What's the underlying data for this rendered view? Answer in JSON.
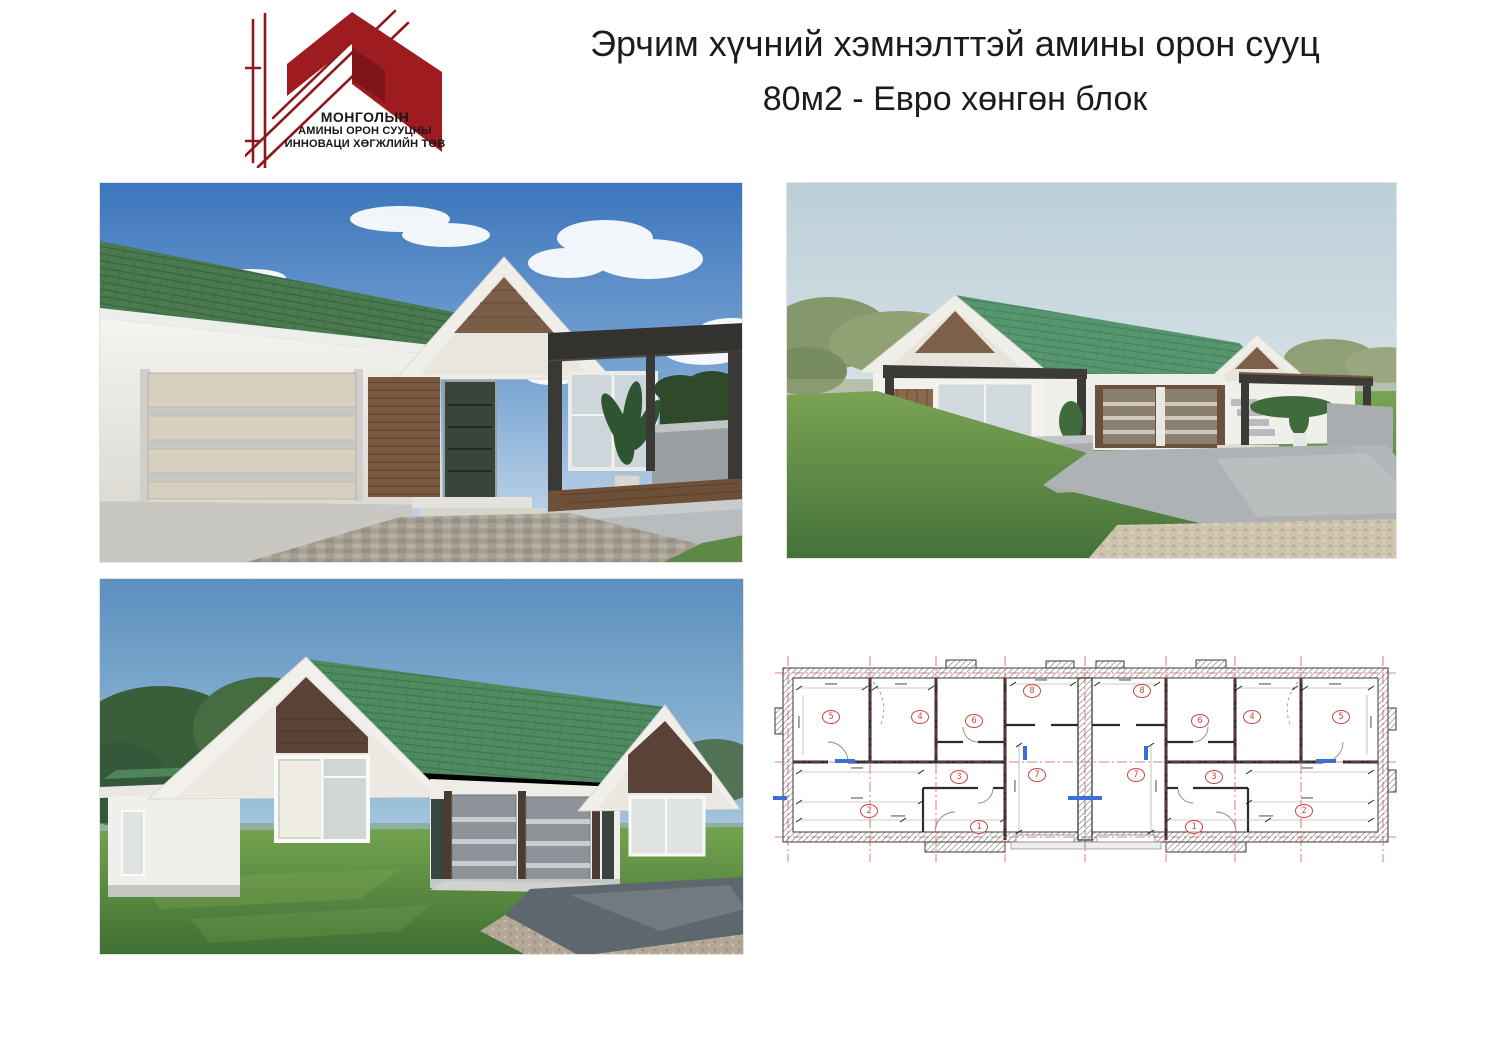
{
  "logo": {
    "org_line1": "МОНГОЛЫН",
    "org_line2": "АМИНЫ ОРОН СУУЦНЫ",
    "org_line3": "ИННОВАЦИ ХӨГЖЛИЙН ТӨВ"
  },
  "title": {
    "line1": "Эрчим хүчний хэмнэлттэй амины орон сууц",
    "line2": "80м2 - Евро хөнгөн блок"
  },
  "plan": {
    "rooms": [
      "1",
      "2",
      "3",
      "4",
      "5",
      "6",
      "7",
      "8"
    ]
  },
  "colors": {
    "page_bg": "#ffffff",
    "title_text": "#1c1c1c",
    "logo_red": "#9e1b20",
    "logo_text": "#161616",
    "roof_green": "#55916b",
    "wall_white": "#f1efe9",
    "gable_wood_brown": "#7b5c45",
    "gable_wood_dark": "#5a4336",
    "pergola_dark": "#3a3936",
    "sky_blue": "#4d82c3",
    "sky_pale": "#c3d3da",
    "sky_steel": "#6f9fc6",
    "grass_green": "#6f9c49",
    "pavement_grey": "#aeb2b4",
    "gravel_tan": "#cec3ad",
    "plan_red": "#d04545",
    "plan_wall": "#2b2b2b",
    "plan_blue": "#3a6fd8"
  }
}
